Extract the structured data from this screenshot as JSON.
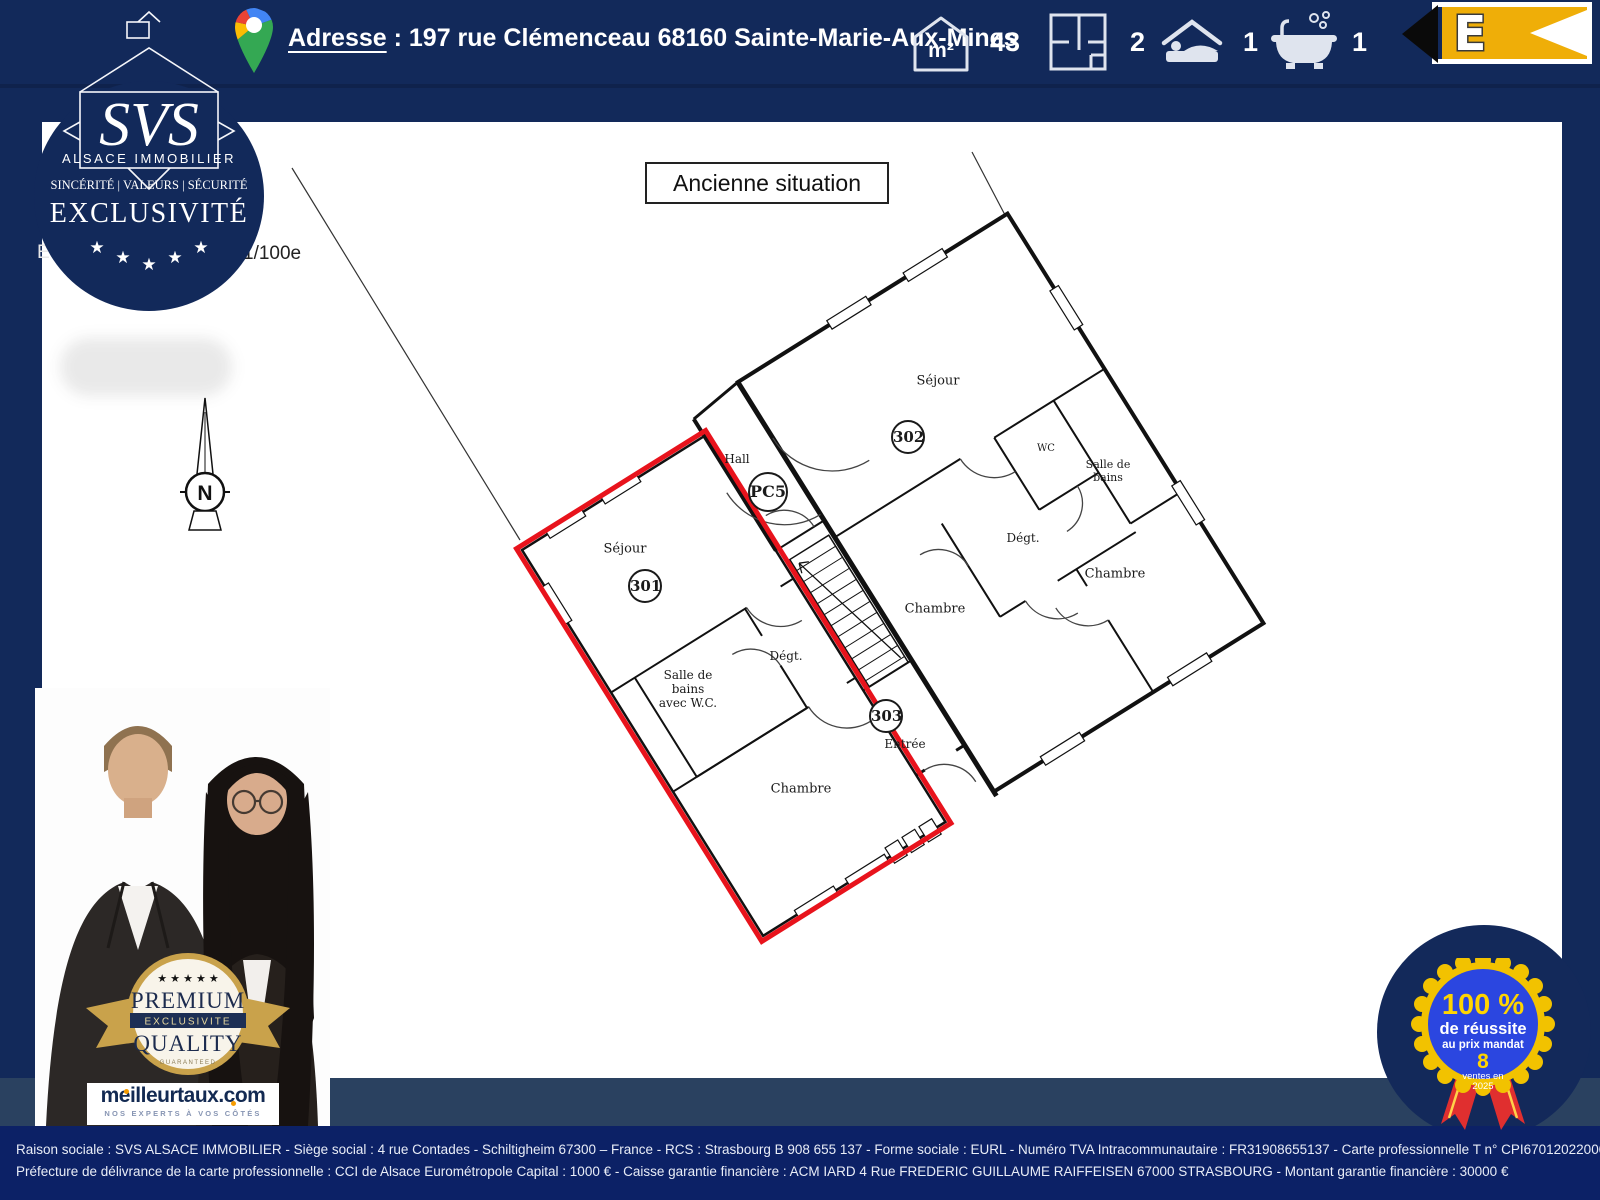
{
  "header": {
    "address_label": "Adresse",
    "address_value": " : 197 rue Clémenceau  68160 Sainte-Marie-Aux-Mines",
    "stats": {
      "area_unit": "m²",
      "area_value": "43",
      "rooms_value": "2",
      "bedrooms_value": "1",
      "bathrooms_value": "1"
    },
    "energy_rating": "E"
  },
  "logo": {
    "name": "SVS",
    "subtitle": "ALSACE IMMOBILIER",
    "values_line": "SINCÉRITÉ | VALEURS | SÉCURITÉ",
    "exclusivity": "EXCLUSIVITÉ",
    "star_glyph": "★"
  },
  "plan": {
    "title": "Ancienne situation",
    "scale_prefix": "É",
    "scale_suffix": "1/100e",
    "compass_letter": "N",
    "labels": {
      "sejour301": "Séjour",
      "lot301": "301",
      "sdb301": "Salle de\nbains\navec W.C.",
      "degt301": "Dégt.",
      "chambre301": "Chambre",
      "hall": "Hall",
      "pc5": "PC5",
      "lot303": "303",
      "entree": "Entrée",
      "sejour302": "Séjour",
      "lot302": "302",
      "wc": "WC",
      "sdb302": "Salle de\nbains",
      "degt302": "Dégt.",
      "chambre302a": "Chambre",
      "chambre302b": "Chambre"
    }
  },
  "premium_badge": {
    "stars": "★ ★ ★ ★ ★",
    "line1": "PREMIUM",
    "band": "EXCLUSIVITE",
    "line2": "QUALITY",
    "line3": "GUARANTEED"
  },
  "meilleurtaux": {
    "brand": "meilleurtaux.com",
    "tagline": "NOS EXPERTS À VOS CÔTÉS"
  },
  "success_badge": {
    "percent": "100 %",
    "line1": "de réussite",
    "line2": "au prix mandat",
    "count": "8",
    "line3": "ventes en",
    "line4": "2025"
  },
  "footer": {
    "line1": "Raison sociale : SVS ALSACE IMMOBILIER - Siège social : 4 rue Contades - Schiltigheim 67300 – France - RCS : Strasbourg B 908 655 137 - Forme sociale : EURL - Numéro TVA Intracommunautaire : FR31908655137 - Carte professionnelle T n° CPI67012022000000004",
    "line2": "Préfecture  de délivrance de la carte professionnelle  : CCI de Alsace Eurométropole    Capital :  1000 € -   Caisse garantie  financière  : ACM  IARD 4 Rue FREDERIC  GUILLAUME  RAIFFEISEN 67000  STRASBOURG  -  Montant  garantie  financière  : 30000 €"
  },
  "colors": {
    "navy": "#12295a",
    "band_mid": "#2a4160",
    "band_legal": "#0c2166",
    "plan_red": "#e8131c",
    "energy_yellow": "#efae08",
    "rosette_yellow": "#f2c200",
    "rosette_blue": "#2b46e0",
    "gold": "#c9a24b"
  }
}
